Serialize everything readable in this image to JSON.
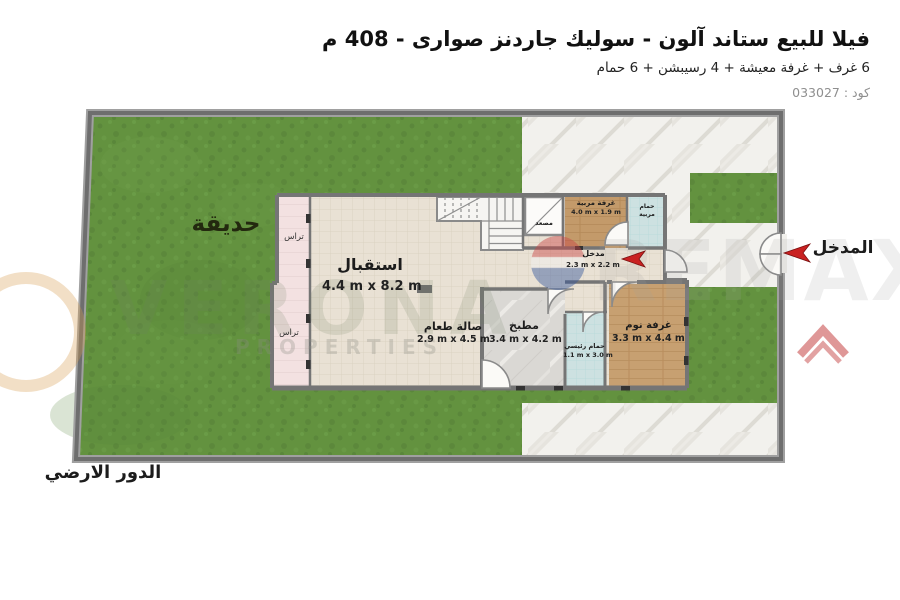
{
  "header": {
    "title": "فيلا للبيع ستاند آلون - سوليك جاردنز صوارى - 408 م",
    "subtitle": "6 غرف + غرفة معيشة + 4 رسيبشن + 6 حمام",
    "code": "كود : 033027"
  },
  "plan": {
    "garden_label": "حديقة",
    "main_entrance_label": "المدخل",
    "floor_label": "الدور الارضي",
    "rooms": {
      "reception": {
        "name": "استقبال",
        "dims": "4.4 m x 8.2 m"
      },
      "dining": {
        "name": "صالة طعام",
        "dims": "2.9 m x 4.5 m"
      },
      "kitchen": {
        "name": "مطبخ",
        "dims": "3.4 m x 4.2 m"
      },
      "bedroom": {
        "name": "غرفة نوم",
        "dims": "3.3 m x 4.4 m"
      },
      "main_bath": {
        "name": "حمام رئيسي",
        "dims": "1.1 m x 3.0 m"
      },
      "nanny_room": {
        "name": "غرفة مربية",
        "dims": "4.0 m x 1.9 m"
      },
      "nanny_bath": {
        "line1": "حمام",
        "line2": "مربية"
      },
      "entry_hall": {
        "name": "مدخل",
        "dims": "2.3 m x 2.2 m"
      },
      "elevator": {
        "name": "مصعد"
      },
      "terrace_upper": {
        "name": "تراس"
      },
      "terrace_lower": {
        "name": "تراس"
      }
    }
  },
  "watermark": {
    "brand_left": "VERONA",
    "brand_left_sub": "PROPERTIES",
    "brand_right": "REMAX"
  },
  "colors": {
    "grass": "#63923f",
    "wall": "#757575",
    "tile": "#e9e1d4",
    "wood": "#c39a6a",
    "bath_blue": "#cde1e1",
    "terrace_pink": "#f3e1e1",
    "stone_path": "#f1f0ec",
    "arrow_red": "#c92121"
  }
}
